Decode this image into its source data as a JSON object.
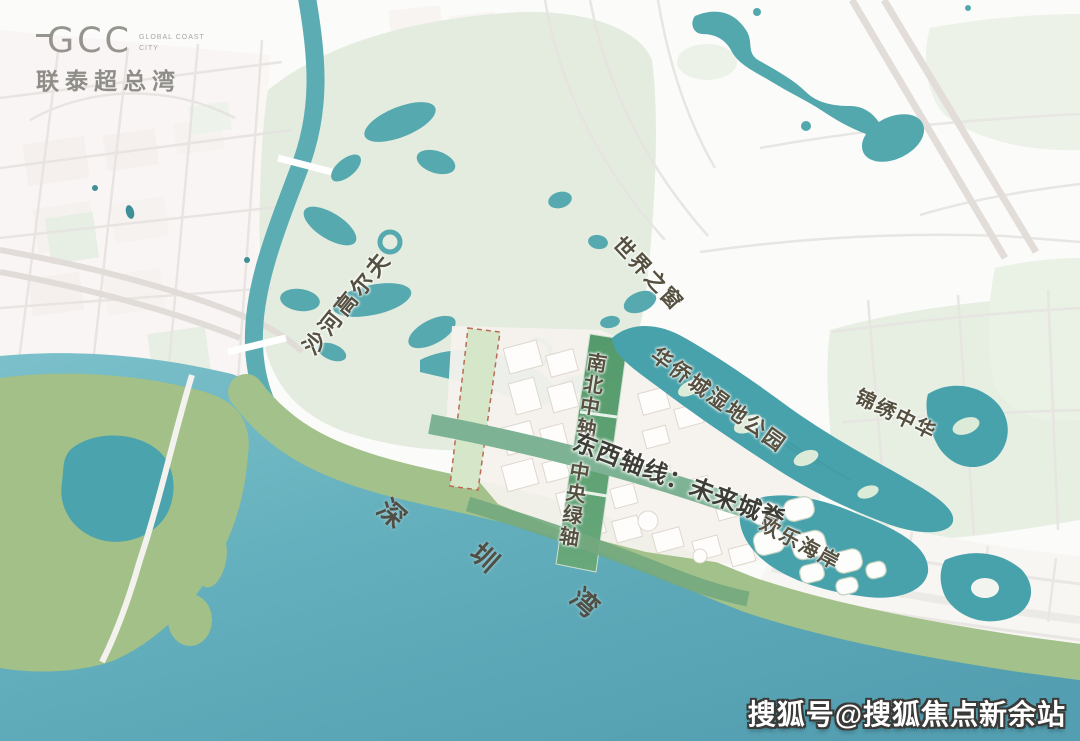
{
  "logo": {
    "brand": "GCC",
    "tagline_line1": "GLOBAL COAST",
    "tagline_line2": "CITY",
    "name": "联泰超总湾"
  },
  "map_labels": {
    "shahe_golf": "沙河高尔夫",
    "window_of_the_world": "世界之窗",
    "oct_wetland_park": "华侨城湿地公园",
    "splendid_china": "锦绣中华",
    "north_south_axis": "南北中轴：中央绿轴",
    "east_west_axis": "东西轴线：未来城脊",
    "oct_harbour": "欢乐海岸",
    "shenzhen_bay": {
      "char1": "深",
      "char2": "圳",
      "char3": "湾"
    }
  },
  "watermark": {
    "text": "搜狐号@搜狐焦点新余站"
  },
  "colors": {
    "bay_water": "#5fa9b8",
    "lake_water": "#48a2ab",
    "river": "#5cadb3",
    "park_light_green": "#e4ecdf",
    "park_sage_green": "#a3c18a",
    "axis_dark_green": "#579b6e",
    "axis_mid_green": "#7db394",
    "parcel_dashed_red": "#bb6a55",
    "label_text": "#55503f",
    "watermark_text": "#ffffff"
  }
}
